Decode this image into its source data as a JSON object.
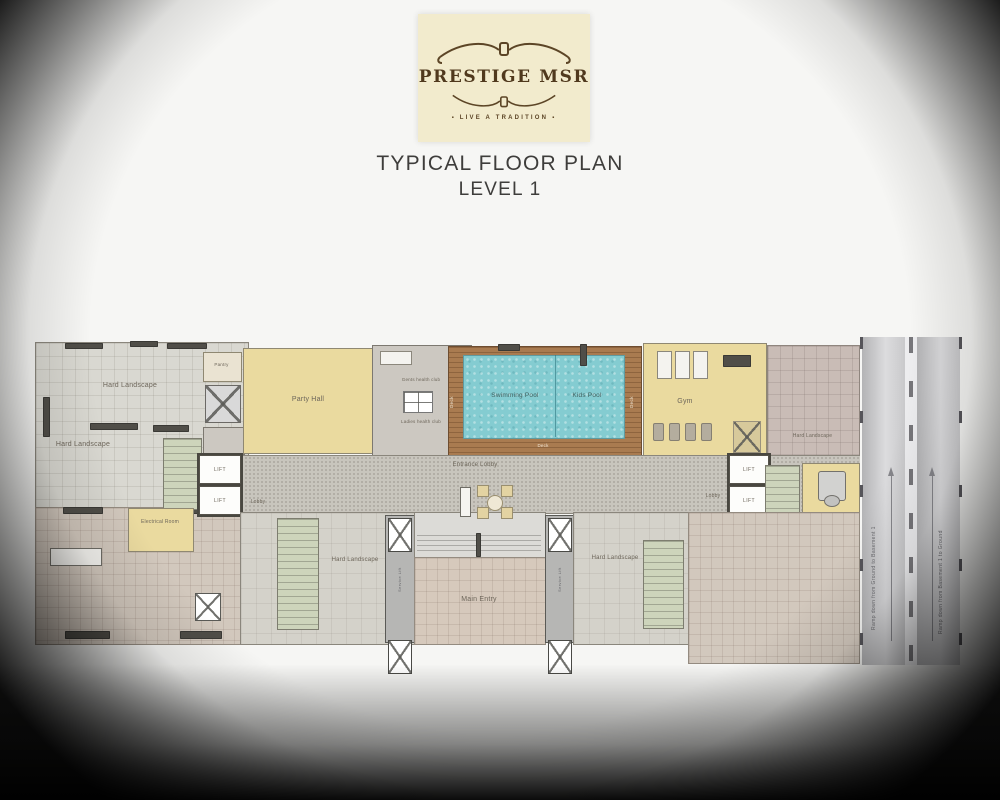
{
  "logo": {
    "brand": "PRESTIGE MSR",
    "tagline": "LIVE A TRADITION"
  },
  "title": {
    "line1": "TYPICAL FLOOR PLAN",
    "line2": "LEVEL 1"
  },
  "plan": {
    "labels": {
      "hard_landscape": "Hard Landscape",
      "pantry": "Pantry",
      "party_hall": "Party Hall",
      "gents_health_club": "Gents health club",
      "ladies_health_club": "Ladies health club",
      "swimming_pool": "Swimming Pool",
      "kids_pool": "Kids Pool",
      "deck": "Deck",
      "gym": "Gym",
      "entrance_lobby": "Entrance Lobby",
      "lobby": "Lobby",
      "lift": "LIFT",
      "service_lift": "Service Lift",
      "electrical_room": "Electrical Room",
      "main_entry": "Main Entry",
      "ramp_down_left": "Ramp down from Ground to Basement 1",
      "ramp_down_right": "Ramp down from Basement 1 to Ground"
    },
    "palette": {
      "pool_teal": "#84ccd1",
      "deck_wood": "#a97b50",
      "room_beige": "#eada9f",
      "stair_green": "#cdd4bb",
      "landscape_gray": "#d9d8d1",
      "paving_pink": "#d2c8bd",
      "walkway_gray": "#c8c5bd",
      "ramp_gray": "#c9c9cb",
      "logo_cream": "#f2ebcd",
      "logo_brown": "#5c4526"
    }
  }
}
